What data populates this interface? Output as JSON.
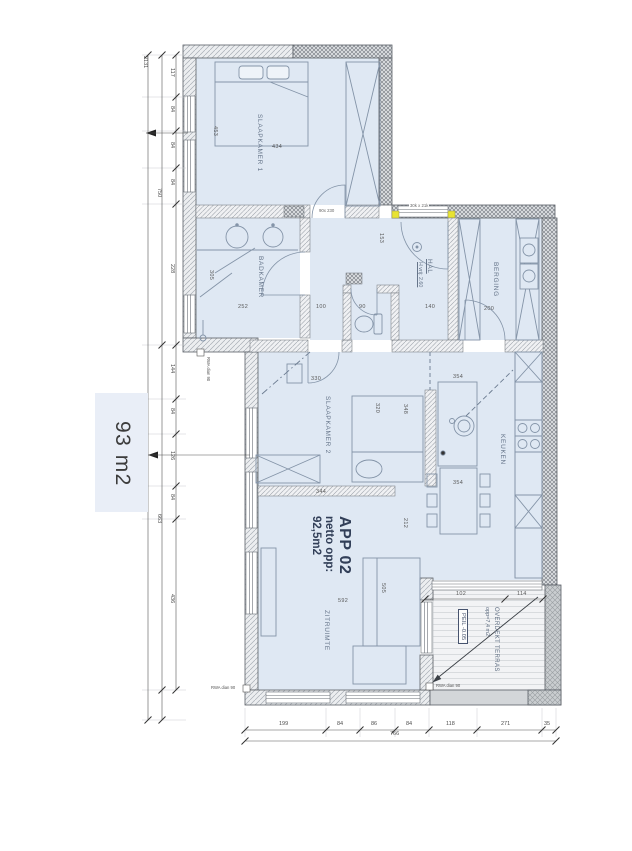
{
  "side_area": "93 m2",
  "apartment": {
    "name": "APP 02",
    "netto_label": "netto opp:",
    "netto_value": "92,5m2"
  },
  "rooms": {
    "slaapkamer1": "SLAAPKAMER 1",
    "badkamer": "BADKAMER",
    "hal": "HAL",
    "hal_note": "H vrij: 2.60",
    "berging": "BERGING",
    "slaapkamer2": "SLAAPKAMER 2",
    "keuken": "KEUKEN",
    "zitruimte": "ZITRUIMTE",
    "terras": "OVERDEKT TERRAS",
    "terras_area": "opp=7,4 m2",
    "terras_level": "PEIL -0.05"
  },
  "notes": {
    "lintel": "30k x 21k",
    "rwa_wall": "RWA dian 90",
    "rwa_floor": "RWA dian 90",
    "rwa_terras": "RWA dian 90",
    "door_sk1": "90x 230"
  },
  "dims": {
    "left_total": "2131",
    "left_mid": [
      "750",
      "663"
    ],
    "left_segs": [
      "117",
      "84",
      "84",
      "84",
      "228",
      "144",
      "84",
      "126",
      "84",
      "436"
    ],
    "bottom_segs": [
      "199",
      "84",
      "86",
      "84",
      "118",
      "271",
      "35"
    ],
    "bottom_total": "766",
    "sk1_width": "434",
    "sk1_height": "453",
    "bad_width": "252",
    "bad_height": "305",
    "hal_w1": "100",
    "wc_width": "90",
    "hal_w2": "140",
    "hal_door": "153",
    "berging_door": "200",
    "sk2_door": "330",
    "sk2_width": "344",
    "sk2_height": "320",
    "pass_height": "348",
    "keuken_w1": "354",
    "keuken_w2": "354",
    "zit_width": "592",
    "zit_h1": "505",
    "zit_h2": "212",
    "terras_w1": "102",
    "terras_w2": "114"
  }
}
